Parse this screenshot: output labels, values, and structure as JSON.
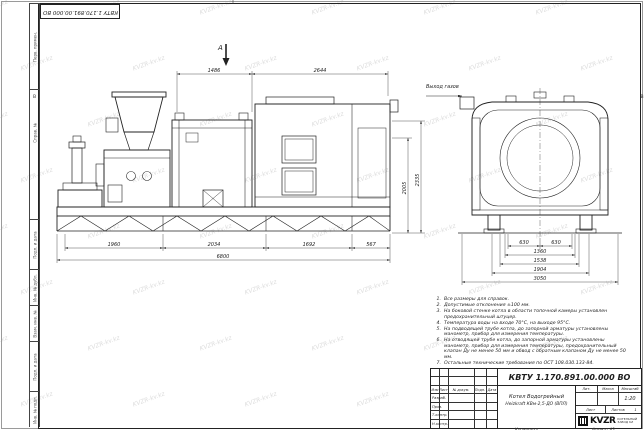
{
  "doc": {
    "number": "КВТУ 1.170.891.00.000 ВО"
  },
  "watermark": {
    "text": "KVZR-kv.kz"
  },
  "frame": {
    "zone_letter": "В"
  },
  "views": {
    "marker_a": "А",
    "gas_outlet": "Выход газов"
  },
  "dims": {
    "top": [
      "1486",
      "2644"
    ],
    "bottom": [
      "1960",
      "2034",
      "1692",
      "567",
      "6800"
    ],
    "vertical": [
      "2005",
      "2335"
    ],
    "end": [
      "630",
      "630",
      "1360",
      "1538",
      "1904",
      "3050"
    ]
  },
  "notes": {
    "items": [
      {
        "num": "1.",
        "text": "Все размеры для справок."
      },
      {
        "num": "2.",
        "text": "Допустимые отклонения ±100 мм."
      },
      {
        "num": "3.",
        "text": "На боковой стенке котла в области топочной камеры установлен предохранительный штуцер."
      },
      {
        "num": "4.",
        "text": "Температура воды на входе 70°С, на выходе 95°С."
      },
      {
        "num": "5.",
        "text": "На подводящей трубе котла, до запорной арматуры установлены манометр, прибор для измерения температуры."
      },
      {
        "num": "6.",
        "text": "На отводящей трубе котла, до запорной арматуры установлены манометр, прибор для измерения температуры, предохранительный клапан Ду не менее 50 мм и обвод с обратным клапаном Ду не менее 50 мм."
      },
      {
        "num": "7.",
        "text": "Остальные технические требования по ОСТ 108.030.133-84."
      }
    ]
  },
  "title_block": {
    "doc_number": "КВТУ 1.170.891.00.000 ВО",
    "name_line1": "Котел Водогрейный",
    "name_line2": "Heizkraft КВм-2,5-ДО (ВПЛ)",
    "header": {
      "izm": "Изм",
      "list": "Лист",
      "dokum": "№ докум.",
      "podp": "Подп.",
      "data": "Дата"
    },
    "rows": [
      "Разраб.",
      "Пров.",
      "Т.контр.",
      "Н.контр.",
      "Утв."
    ],
    "lit_label": "Лит.",
    "mass_label": "Масса",
    "scale_label": "Масштаб",
    "scale_value": "1:20",
    "sheet_label": "Лист",
    "sheets_label": "Листов",
    "sheets_value": "1",
    "logo_text": "KVZR",
    "logo_sub1": "КОТЕЛЬНЫЙ",
    "logo_sub2": "ЗАВОД KZ",
    "copied_label": "Копировал",
    "format_label": "Формат А3"
  },
  "side_strips": [
    "Перв. примен.",
    "Справ. №",
    "Подп. и дата",
    "Инв. № дубл.",
    "Взам. инв. №",
    "Подп. и дата",
    "Инв. № подл."
  ]
}
